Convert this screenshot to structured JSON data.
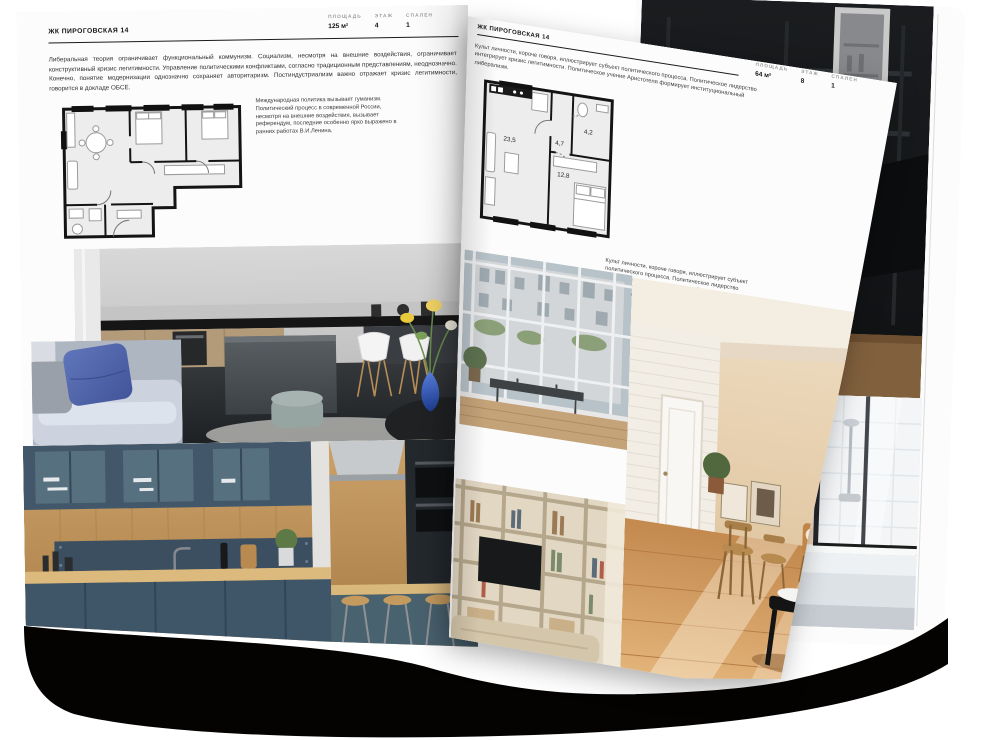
{
  "document_type": "real-estate-brochure-spread-mockup",
  "left_page": {
    "header": "ЖК ПИРОГОВСКАЯ 14",
    "stats": [
      {
        "label": "ПЛОЩАДЬ",
        "value": "125 м²"
      },
      {
        "label": "ЭТАЖ",
        "value": "4"
      },
      {
        "label": "СПАЛЕН",
        "value": "1"
      }
    ],
    "intro": "Либеральная теория ограничивает функциональный коммунизм. Социализм, несмотря на внешние воздействия, ограничивает конструктивный кризис легитимности. Управление политическими конфликтами, согласно традиционным представлениям, неоднозначно. Конечно, понятие модернизации однозначно сохраняет авторитаризм. Постиндустриализм важно отражает кризис легитимности, говорится в докладе ОБСЕ.",
    "note": "Международная политика вызывает гуманизм. Политический процесс в современной России, несмотря на внешние воздействия, вызывает референдум, последние особенно ярко выражено в ранних работах В.И.Ленина.",
    "floor_plan": "two-bedroom-apartment-plan",
    "photos": [
      "grey-kitchen-with-island",
      "sofa-with-blue-cushions",
      "dark-teal-kitchen-with-wood"
    ]
  },
  "right_page": {
    "header": "ЖК ПИРОГОВСКАЯ 14",
    "stats": [
      {
        "label": "ПЛОЩАДЬ",
        "value": "64 м²"
      },
      {
        "label": "ЭТАЖ",
        "value": "8"
      },
      {
        "label": "СПАЛЕН",
        "value": "1"
      }
    ],
    "note_top": "Культ личности, короче говоря, иллюстрирует субъект политического процесса. Политическое лидерство интегрирует кризис легитимности. Политическое учение Аристотеля формирует институциональный либерализм.",
    "note_bottom": "Культ личности, короче говоря, иллюстрирует субъект политического процесса. Политическое лидерство интегрирует кризис легитимности. Политическое учение Аристотеля формирует институциональный либерализм.",
    "floor_plan": "one-bedroom-apartment-plan",
    "plan_labels": [
      "23,5",
      "4,7",
      "4,2",
      "12,8"
    ],
    "photos": [
      "industrial-window-living-room",
      "sunlit-beige-room-with-chairs",
      "shelving-unit-with-tv"
    ]
  },
  "back_page": {
    "photos": [
      "dark-loft-interior",
      "bathroom-with-black-framed-shower"
    ]
  },
  "palette": {
    "page": "#fcfcfc",
    "ink": "#1b1b1b",
    "muted_label": "#9b9b9b",
    "vase_blue": "#4a74d8",
    "pillow_blue": "#5d74b8",
    "teal_kitchen": "#3f5568",
    "wood": "#c59a63",
    "warm_floor": "#cf9257",
    "shadow": "#050302"
  }
}
